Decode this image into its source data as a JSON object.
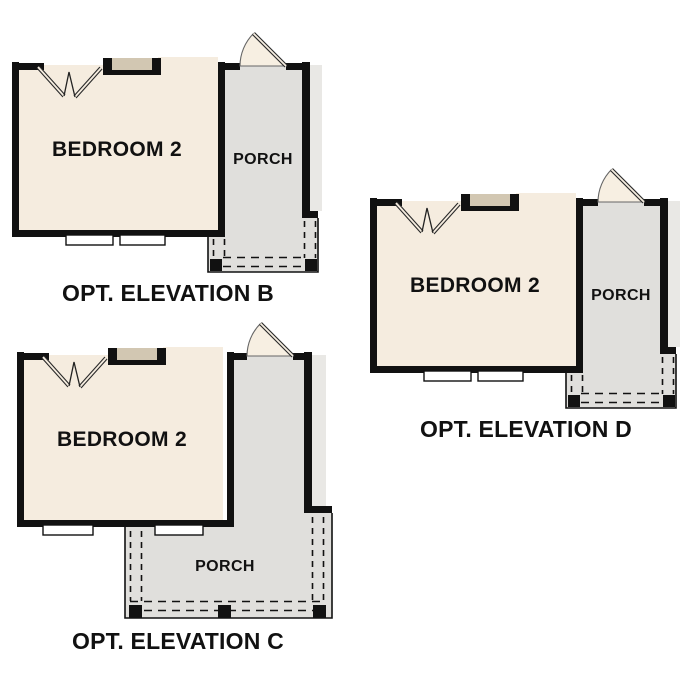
{
  "plans": [
    {
      "id": "elevation-b",
      "room_label": "BEDROOM 2",
      "porch_label": "PORCH",
      "caption": "OPT. ELEVATION B"
    },
    {
      "id": "elevation-c",
      "room_label": "BEDROOM 2",
      "porch_label": "PORCH",
      "caption": "OPT. ELEVATION C"
    },
    {
      "id": "elevation-d",
      "room_label": "BEDROOM 2",
      "porch_label": "PORCH",
      "caption": "OPT. ELEVATION D"
    }
  ],
  "colors": {
    "wall": "#111111",
    "room": "#f5ecdf",
    "porch": "#e0dfdc",
    "eave": "#e9e8e5",
    "niche": "#d2c7b2",
    "fan": "#f7efe2",
    "text": "#111111",
    "bg": "#ffffff"
  }
}
